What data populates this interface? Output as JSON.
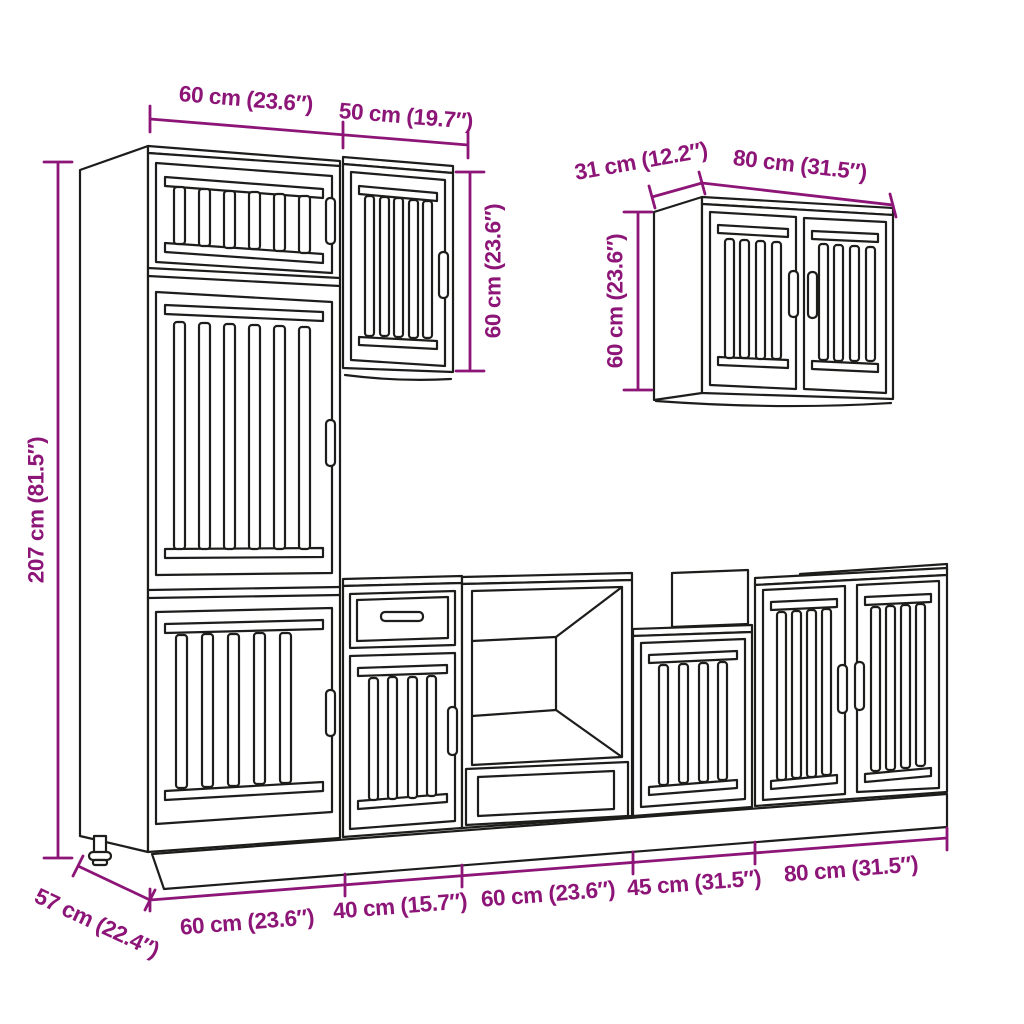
{
  "meta": {
    "title": "Kitchen cabinet set dimension diagram",
    "style": "black line art on white with magenta dimension lines"
  },
  "colors": {
    "background": "#ffffff",
    "line": "#1d1d1b",
    "dimension": "#8C1577"
  },
  "dims": {
    "tall_width": "60 cm (23.6″)",
    "wall50_width": "50 cm (19.7″)",
    "wall50_height": "60 cm (23.6″)",
    "wall80_depth": "31 cm (12.2″)",
    "wall80_width": "80 cm (31.5″)",
    "wall80_height": "60 cm (23.6″)",
    "tall_height": "207 cm (81.5″)",
    "base_depth": "57 cm (22.4″)",
    "base1_width": "60 cm (23.6″)",
    "base2_width": "40 cm (15.7″)",
    "base3_width": "60 cm (23.6″)",
    "base4_width": "45 cm (31.5″)",
    "base5_width": "80 cm (31.5″)"
  }
}
